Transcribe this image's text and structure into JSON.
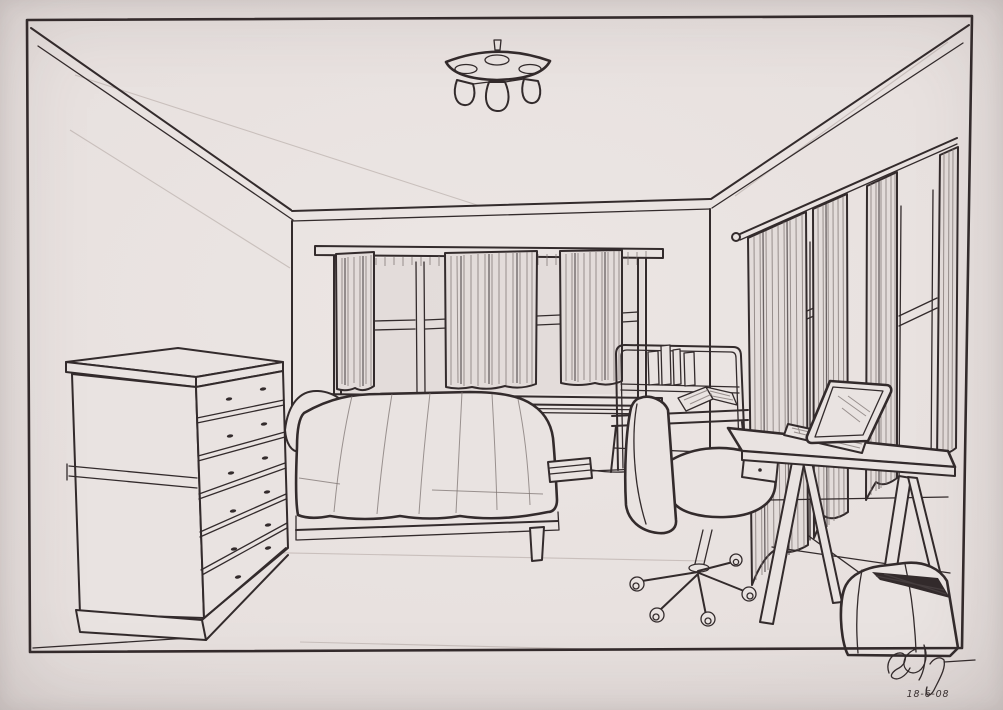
{
  "artwork": {
    "title": "One-point perspective bedroom drawing",
    "medium": "pen-and-ink sketch photographed on paper",
    "signature": "cursive artist initials",
    "date": "18-6-08"
  },
  "palette": {
    "paper": "#e9e3e1",
    "ink": "#332b2c",
    "pencil_guides": "#c0b6b3",
    "curtain_wash": "#e3dcda"
  },
  "scene": {
    "objects": [
      "three-bulb ceiling light",
      "wide back window with curtain panels and sill",
      "right wall windows with hanging curtains",
      "six-drawer dresser",
      "bed with pillow and draped blanket",
      "power strip on floor",
      "student desk hutch with books and open book",
      "swivel office chair on five-caster base",
      "trestle desk with drawer",
      "open laptop",
      "bag on floor"
    ]
  }
}
